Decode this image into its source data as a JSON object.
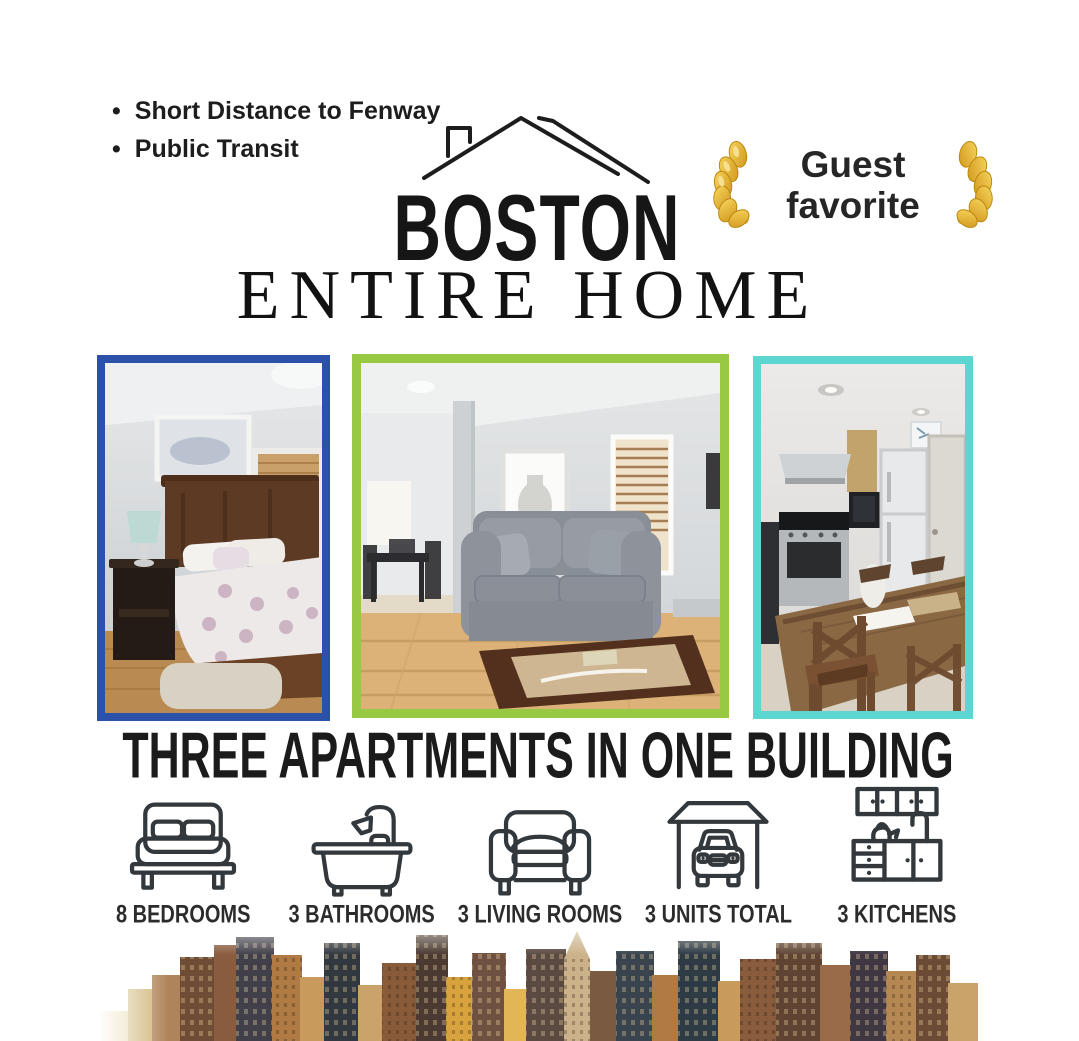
{
  "page": {
    "background": "#ffffff",
    "text_color": "#1c1c1c"
  },
  "features": {
    "items": [
      "Short Distance to Fenway",
      "Public Transit"
    ]
  },
  "logo": {
    "title": "BOSTON",
    "subtitle": "ENTIRE HOME",
    "icon": "house-roof-icon"
  },
  "badge": {
    "line1": "Guest",
    "line2": "favorite",
    "icon": "laurel-icon",
    "laurel_color": "#e3ae35"
  },
  "photos": [
    {
      "name": "bedroom-photo",
      "border_color": "#2b51a9"
    },
    {
      "name": "living-room-photo",
      "border_color": "#97ca42"
    },
    {
      "name": "kitchen-photo",
      "border_color": "#5dd6d2"
    }
  ],
  "headline": {
    "text": "THREE APARTMENTS IN ONE BUILDING"
  },
  "stats": [
    {
      "icon": "bed-icon",
      "label": "8 BEDROOMS"
    },
    {
      "icon": "bathtub-icon",
      "label": "3 BATHROOMS"
    },
    {
      "icon": "sofa-icon",
      "label": "3 LIVING ROOMS"
    },
    {
      "icon": "car-garage-icon",
      "label": "3 UNITS TOTAL"
    },
    {
      "icon": "kitchen-cabinets-icon",
      "label": "3 KITCHENS"
    }
  ],
  "footer": {
    "image": "boston-skyline-photo"
  }
}
